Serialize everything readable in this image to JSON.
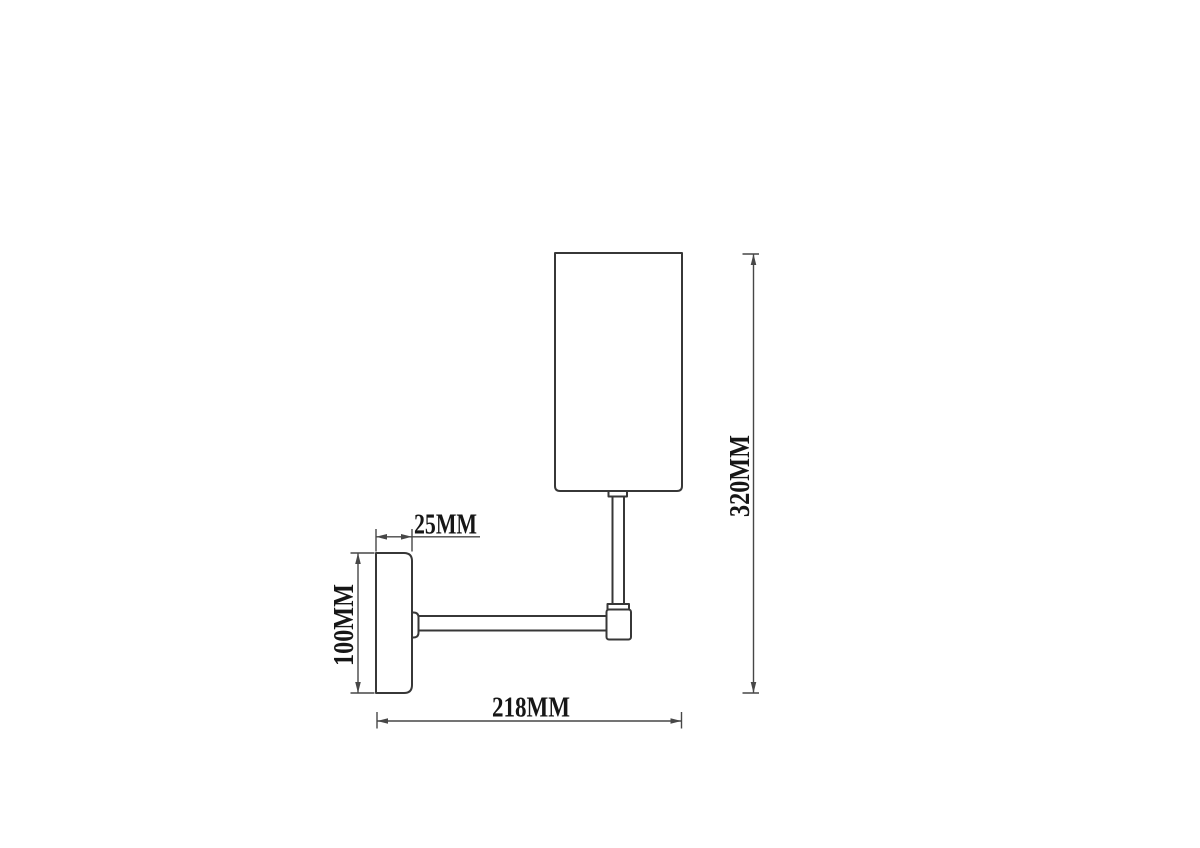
{
  "theme": {
    "bg": "#ffffff",
    "part-stroke": "#373737",
    "dim-stroke": "#474747",
    "text-color": "#161616"
  },
  "drawing": {
    "type": "technical-dimension-drawing",
    "subject": "wall-lamp-side-view"
  },
  "dimensions": {
    "plate_depth": {
      "label": "25MM",
      "value_mm": 25
    },
    "plate_height": {
      "label": "100MM",
      "value_mm": 100
    },
    "projection": {
      "label": "218MM",
      "value_mm": 218
    },
    "overall_height": {
      "label": "320MM",
      "value_mm": 320
    }
  }
}
